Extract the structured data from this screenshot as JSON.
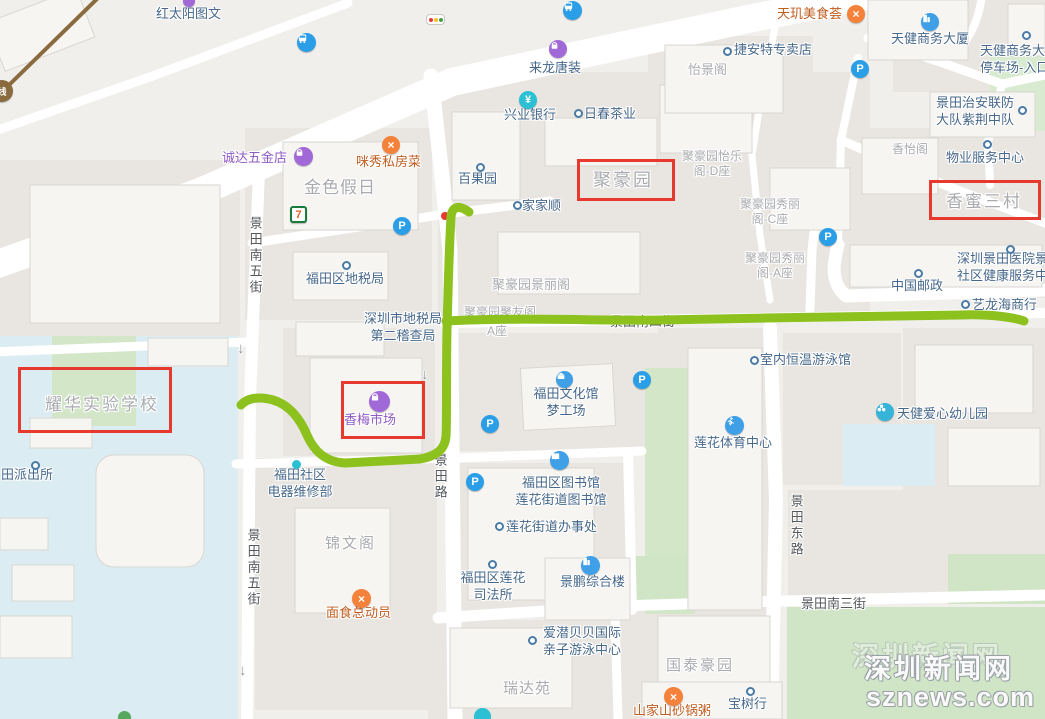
{
  "colors": {
    "highlight_red": "#e8392e",
    "route_green": "#8cc11e",
    "poi_blue": "#47688b",
    "estate_gray": "#a9abae",
    "restaurant_orange": "#bf5d20",
    "shopping_purple": "#8f5bc4",
    "park_green": "#d2e7c9",
    "water_blue": "#dbedf2",
    "road_white": "#ffffff"
  },
  "watermark": {
    "line1": "深圳新闻网",
    "line2": "sznews.com"
  },
  "streets": {
    "jingtian_s5": "景田南五街",
    "jingtian_rd": "景田路",
    "jingtian_east": "景田东路",
    "jingtian_s3": "景田南三街",
    "jingtian_s4": "景田南四街",
    "one_way_arrow": "↓"
  },
  "places": {
    "hongtaiyang_tuwen": "红太阳图文",
    "lailong_tangzhuang": "来龙唐装",
    "jieante": "捷安特专卖店",
    "tianji_meishihui": "天玑美食荟",
    "tianjian_tower": "天健商务大厦",
    "tianjian_parking": "天健商务大厦\n停车场-入口",
    "yijing_ge": "怡景阁",
    "xingye_bank": "兴业银行",
    "richun_tea": "日春茶业",
    "jingtian_patrol": "景田治安联防\n大队紫荆中队",
    "chengda_hardware": "诚达五金店",
    "mixiu_restaurant": "咪秀私房菜",
    "jinse_jiari": "金色假日",
    "baiguoyuan": "百果园",
    "juhaoyuan": "聚豪园",
    "jhy_yile_d": "聚豪园怡乐\n阁-D座",
    "jiajiashun": "家家顺",
    "xiangmi_sancun": "香蜜三村",
    "wuye_center": "物业服务中心",
    "xiangyi_ge": "香怡阁",
    "futian_tax": "福田区地税局",
    "jhy_jingli": "聚豪园景丽阁",
    "sz_tax_audit": "深圳市地税局\n第二稽查局",
    "jhy_juyou": "聚豪园聚友阁",
    "jhy_juyou_a": "A座",
    "jhy_xiuli_c": "聚豪园秀丽\n阁-C座",
    "jhy_xiuli_a": "聚豪园秀丽\n阁-A座",
    "jingtian_hospital": "深圳景田医院景田\n社区健康服务中心",
    "china_post": "中国邮政",
    "yilonghai": "艺龙海商行",
    "yaohua_school": "耀华实验学校",
    "paichusuo": "田派出所",
    "indoor_pool": "室内恒温游泳馆",
    "futian_culture": "福田文化馆\n梦工场",
    "lianhua_sports": "莲花体育中心",
    "tianjian_kindergarten": "天健爱心幼儿园",
    "xiangmei_market": "香梅市场",
    "futian_repair": "福田社区\n电器维修部",
    "futian_library": "福田区图书馆\n莲花街道图书馆",
    "lianhua_office": "莲花街道办事处",
    "lianhua_justice": "福田区莲花\n司法所",
    "jingpeng_building": "景鹏综合楼",
    "jinwen_ge": "锦文阁",
    "mianshi_zongdongyuan": "面食总动员",
    "aiqian_swim": "爱潜贝贝国际\n亲子游泳中心",
    "ruida_yuan": "瑞达苑",
    "guotai_haoyuan": "国泰豪园",
    "shanjiashan_porridge": "山家山砂锅粥",
    "baoshu_hang": "宝树行"
  },
  "icons": {
    "metro_line_badge": "线",
    "parking": "P",
    "bank_yuan": "¥",
    "seven_eleven": "7",
    "restaurant_glyph": "×"
  },
  "highlights": {
    "color": "#e8392e",
    "boxed_places": [
      "聚豪园",
      "香蜜三村",
      "香梅市场",
      "耀华实验学校"
    ]
  }
}
